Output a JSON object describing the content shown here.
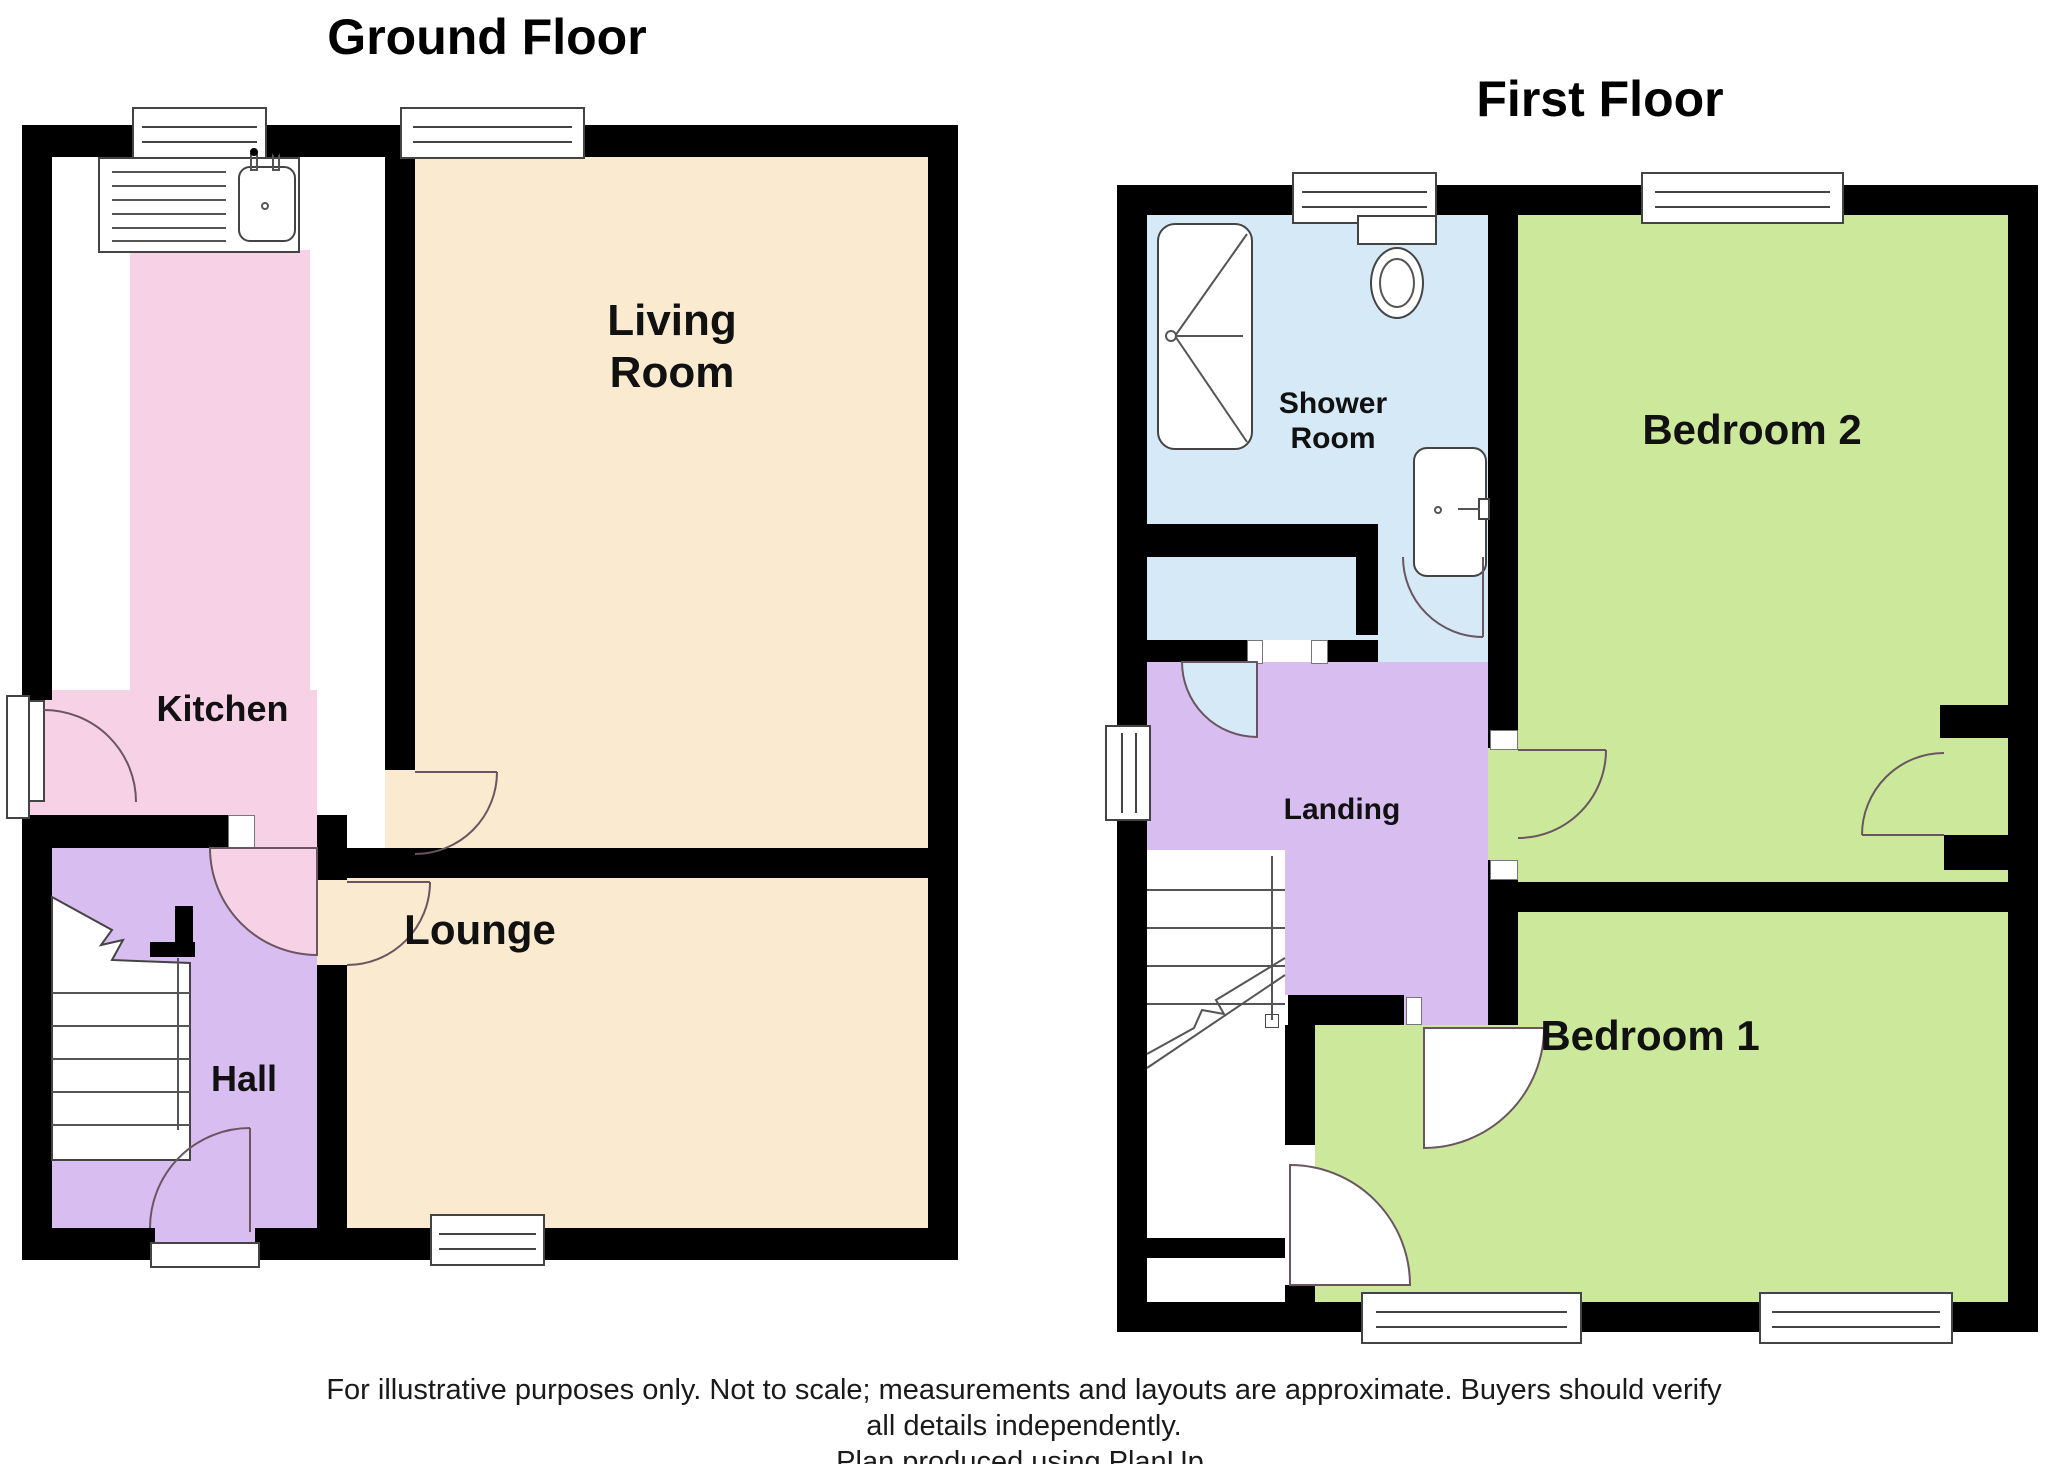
{
  "titles": {
    "ground": "Ground Floor",
    "first": "First Floor"
  },
  "rooms": {
    "living_room": "Living Room",
    "kitchen": "Kitchen",
    "lounge": "Lounge",
    "hall": "Hall",
    "shower_room": "Shower Room",
    "landing": "Landing",
    "bedroom2": "Bedroom 2",
    "bedroom1": "Bedroom 1"
  },
  "disclaimer": {
    "line1": "For illustrative purposes only. Not to scale; measurements and layouts are approximate. Buyers should verify",
    "line2": "all details independently.",
    "line3": "Plan produced using PlanUp."
  },
  "colors": {
    "wall": "#000000",
    "cream": "#FAEACF",
    "pink": "#F7D2E6",
    "lavender": "#D8BEF0",
    "blue": "#D5E9F7",
    "green": "#CCE89B",
    "line": "#555555"
  }
}
